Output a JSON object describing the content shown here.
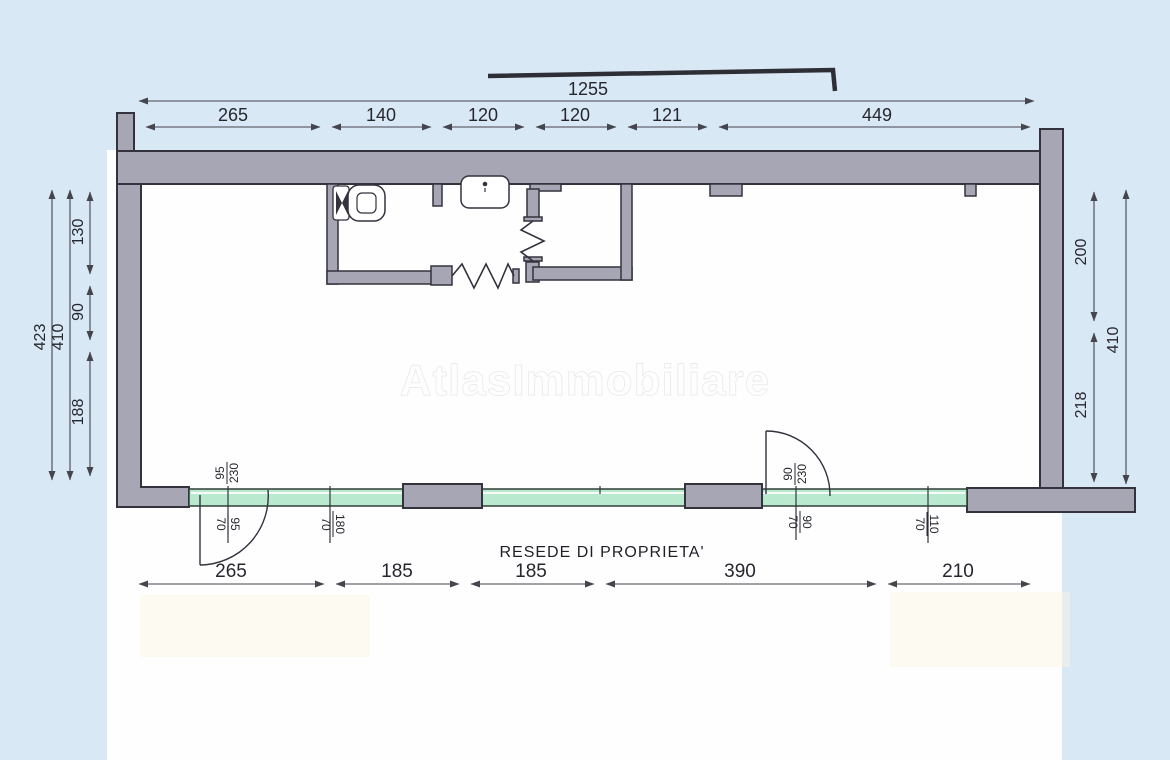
{
  "watermark": "AtlasImmobiliare",
  "footer_label": "RESEDE DI PROPRIETA'",
  "dimensions": {
    "top_total": "1255",
    "top_segments": [
      "265",
      "140",
      "120",
      "120",
      "121",
      "449"
    ],
    "bottom_segments": [
      "265",
      "185",
      "185",
      "390",
      "210"
    ],
    "left_overall": "423",
    "left_inner": "410",
    "left_segments": [
      "130",
      "90",
      "188"
    ],
    "right_segments": [
      "200",
      "218"
    ],
    "right_overall": "410"
  },
  "openings": [
    {
      "w": "95",
      "h": "230"
    },
    {
      "w": "95",
      "h": "70"
    },
    {
      "w": "180",
      "h": "70"
    },
    {
      "w": "90",
      "h": "230"
    },
    {
      "w": "90",
      "h": "70"
    },
    {
      "w": "110",
      "h": "70"
    }
  ],
  "colors": {
    "background": "#d9e8f5",
    "paper": "#fefefe",
    "wall": "#a7a6b4",
    "outline": "#33323d",
    "glazing": "#b9ead0",
    "tint": "#faf6e3"
  }
}
